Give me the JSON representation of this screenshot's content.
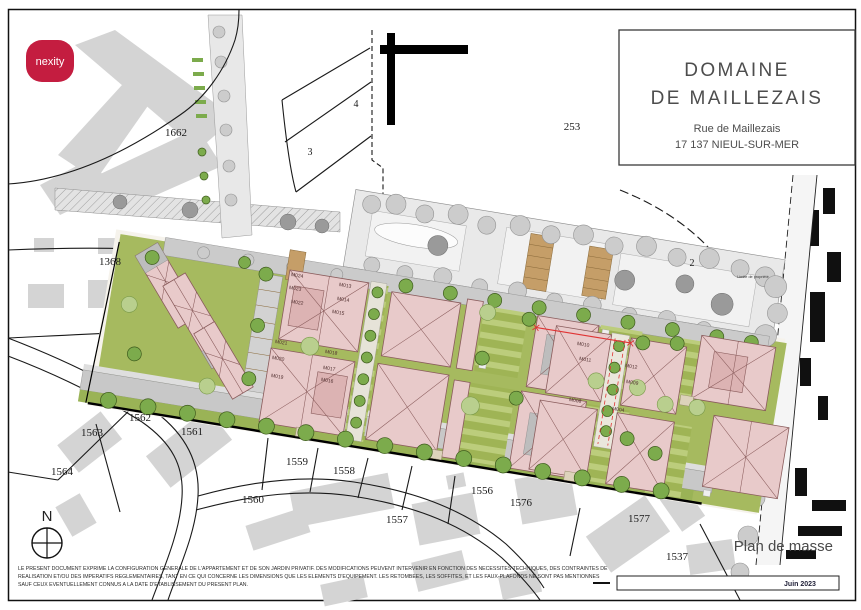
{
  "page": {
    "logo_text": "nexity",
    "title_block": {
      "title1": "DOMAINE",
      "title2": "DE MAILLEZAIS",
      "address1": "Rue de Maillezais",
      "address2": "17 137 NIEUL-SUR-MER"
    },
    "plan_label": "Plan de masse",
    "date": "Juin 2023",
    "north": "N",
    "disclaimer1": "LE PRESENT DOCUMENT EXPRIME LA CONFIGURATION GENERALE DE L'APPARTEMENT ET DE SON JARDIN PRIVATIF. DES MODIFICATIONS PEUVENT INTERVENIR EN FONCTION DES NECESSITES TECHNIQUES, DES CONTRAINTES DE",
    "disclaimer2": "REALISATION ET/OU DES IMPERATIFS REGLEMENTAIRES, TANT EN CE QUI CONCERNE LES DIMENSIONS QUE LES ELEMENTS D'EQUIPEMENT. LES RETOMBEES, LES SOFFITES, ET LES FAUX-PLAFONDS NE SONT PAS MENTIONNES",
    "disclaimer3": "SAUF CEUX EVENTUELLEMENT CONNUS A LA DATE D'ETABLISSEMENT DU PRESENT PLAN."
  },
  "map": {
    "parcels": [
      "1662",
      "1368",
      "4",
      "3",
      "253",
      "2",
      "1563",
      "1564",
      "1562",
      "1561",
      "1560",
      "1559",
      "1558",
      "1557",
      "1556",
      "1576",
      "1577",
      "1537"
    ],
    "lots": [
      "M024",
      "M023",
      "M022",
      "M013",
      "M014",
      "M015",
      "M021",
      "M020",
      "M019",
      "M018",
      "M017",
      "M016",
      "M010",
      "M011",
      "M012",
      "M009",
      "M008",
      "M004"
    ],
    "annotation": "Limite de propriété"
  },
  "colors": {
    "nexity_red": "#c41d40",
    "building_pink": "#e8caca",
    "garden_green": "#a6ba5f",
    "tree_green": "#7cab4c",
    "boundary_red": "#e03434"
  }
}
